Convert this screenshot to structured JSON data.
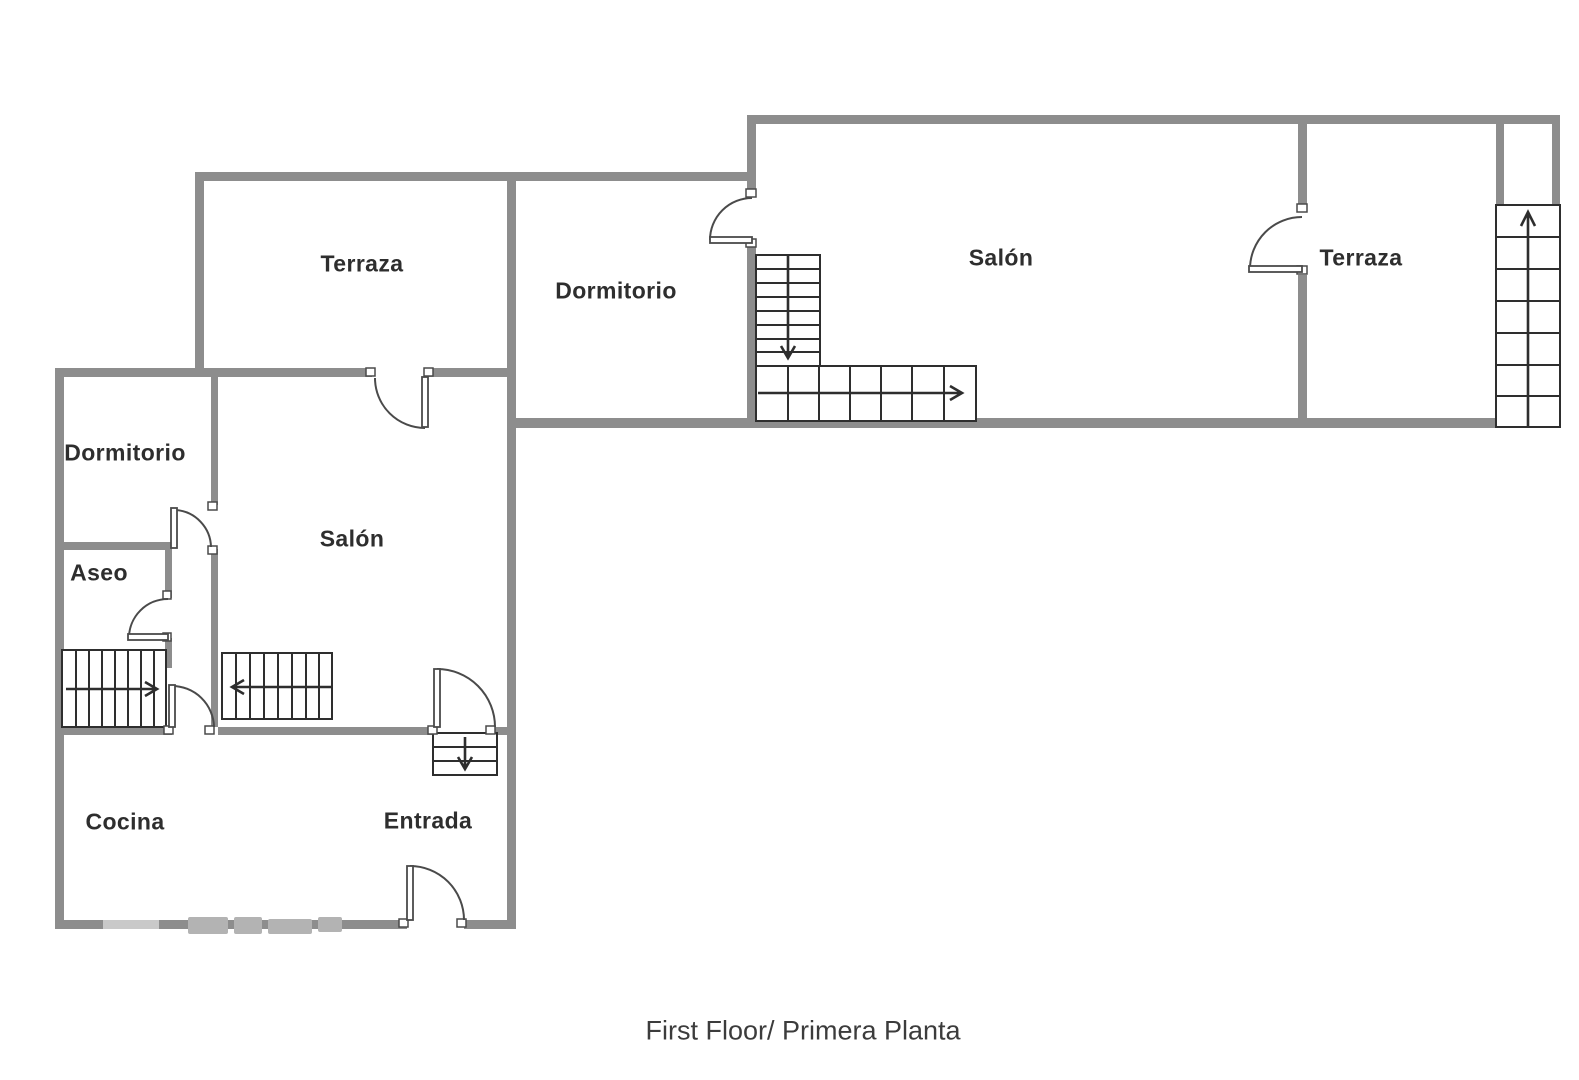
{
  "rooms": {
    "terraza_top_left": "Terraza",
    "dormitorio_middle": "Dormitorio",
    "salon_upper": "Salón",
    "terraza_right": "Terraza",
    "dormitorio_left": "Dormitorio",
    "aseo": "Aseo",
    "salon_left": "Salón",
    "cocina": "Cocina",
    "entrada": "Entrada"
  },
  "caption": "First Floor/ Primera Planta",
  "stairs": [
    {
      "id": "left-hall-staircase",
      "arrow_direction": "right"
    },
    {
      "id": "left-salon-staircase",
      "arrow_direction": "left"
    },
    {
      "id": "entrada-steps",
      "arrow_direction": "down"
    },
    {
      "id": "upper-staircase-vertical-flight",
      "arrow_direction": "down"
    },
    {
      "id": "upper-staircase-horizontal-flight",
      "arrow_direction": "right"
    },
    {
      "id": "right-shaft-staircase",
      "arrow_direction": "up"
    }
  ],
  "doors": [
    {
      "id": "terraza-tl-to-salon-left"
    },
    {
      "id": "dormitorio-left-to-salon-left"
    },
    {
      "id": "aseo-door"
    },
    {
      "id": "hall-to-cocina"
    },
    {
      "id": "salon-left-to-entrada"
    },
    {
      "id": "front-entrance-door"
    },
    {
      "id": "dormitorio-middle-to-salon-upper"
    },
    {
      "id": "salon-upper-to-terraza-right"
    }
  ],
  "colors": {
    "background": "#ffffff",
    "wall": "#8d8d8d",
    "stair_line": "#2e2e2e",
    "door_line": "#4a4a4a",
    "label_text": "#2e2e2e",
    "caption_text": "#3c3c3c",
    "watermark": "#b3b3b3"
  }
}
